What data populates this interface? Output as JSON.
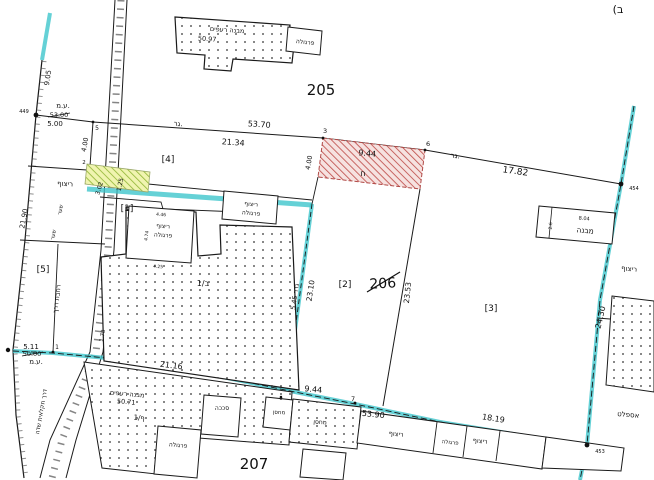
{
  "parcels": {
    "p205": "205",
    "p206": "206",
    "p207": "207"
  },
  "subparcels": {
    "s1": "[1]",
    "s2": "[2]",
    "s3": "[3]",
    "s4": "[4]",
    "s5": "[5]"
  },
  "points": {
    "p449": "449",
    "p454": "454",
    "p453": "453",
    "p1": "1",
    "p2": "2",
    "p3": "3",
    "p5": "5",
    "p6": "6",
    "p7": "7",
    "p9": "9"
  },
  "measurements": {
    "m9_05": "9.05",
    "m5_00": "5.00",
    "m53_00_struck": "53.00",
    "m53_70": "53.70",
    "m21_34": "21.34",
    "m4_00_left": "4.00",
    "m4_00_red": "4.00",
    "m9_44_top": "9.44",
    "m17_82": "17.82",
    "m3_02": "3.02",
    "m1_25": "1.25",
    "m21_90": "21.90",
    "m1_78": "1.78",
    "m23_10": "23.10",
    "m23_53": "23.53",
    "m24_30": "24.30",
    "fence_5_45": "גדר 5.45",
    "m5_11": "5.11",
    "m50_00_struck": "50.00",
    "m21_16": "21.16",
    "m9_44_bottom": "9.44",
    "m53_90": "53.90",
    "m18_19": "18.19",
    "m8_04": "8.04",
    "m2_6": "2.6",
    "m50_97": "50.97",
    "m50_71": "50.71",
    "m4_46": "4.46",
    "m4_74": "4.74",
    "m4_25": "4.25"
  },
  "labels": {
    "tiled_building": "מבנה רעפים",
    "pergola": "פרגולה",
    "tiling": "ריצוף",
    "shed": "סככה",
    "storage": "מחסן",
    "building": "מבנה",
    "asphalt": "אספלט",
    "gate": "שער",
    "road_widening": "רחבת דרך",
    "farm_road": "דרך חקלאית שדה",
    "surveyor_em": "ע.מ.",
    "gar": "גר.",
    "building_b1": "1/ב",
    "building_f1": "1/ף",
    "het": "ח",
    "corner_fragment": "(ב"
  },
  "colors": {
    "boundary_cyan": "#3fc6cc",
    "red_hatch": "#c0504d",
    "green_hatch": "#95b83a",
    "line": "#1a1a1a"
  }
}
